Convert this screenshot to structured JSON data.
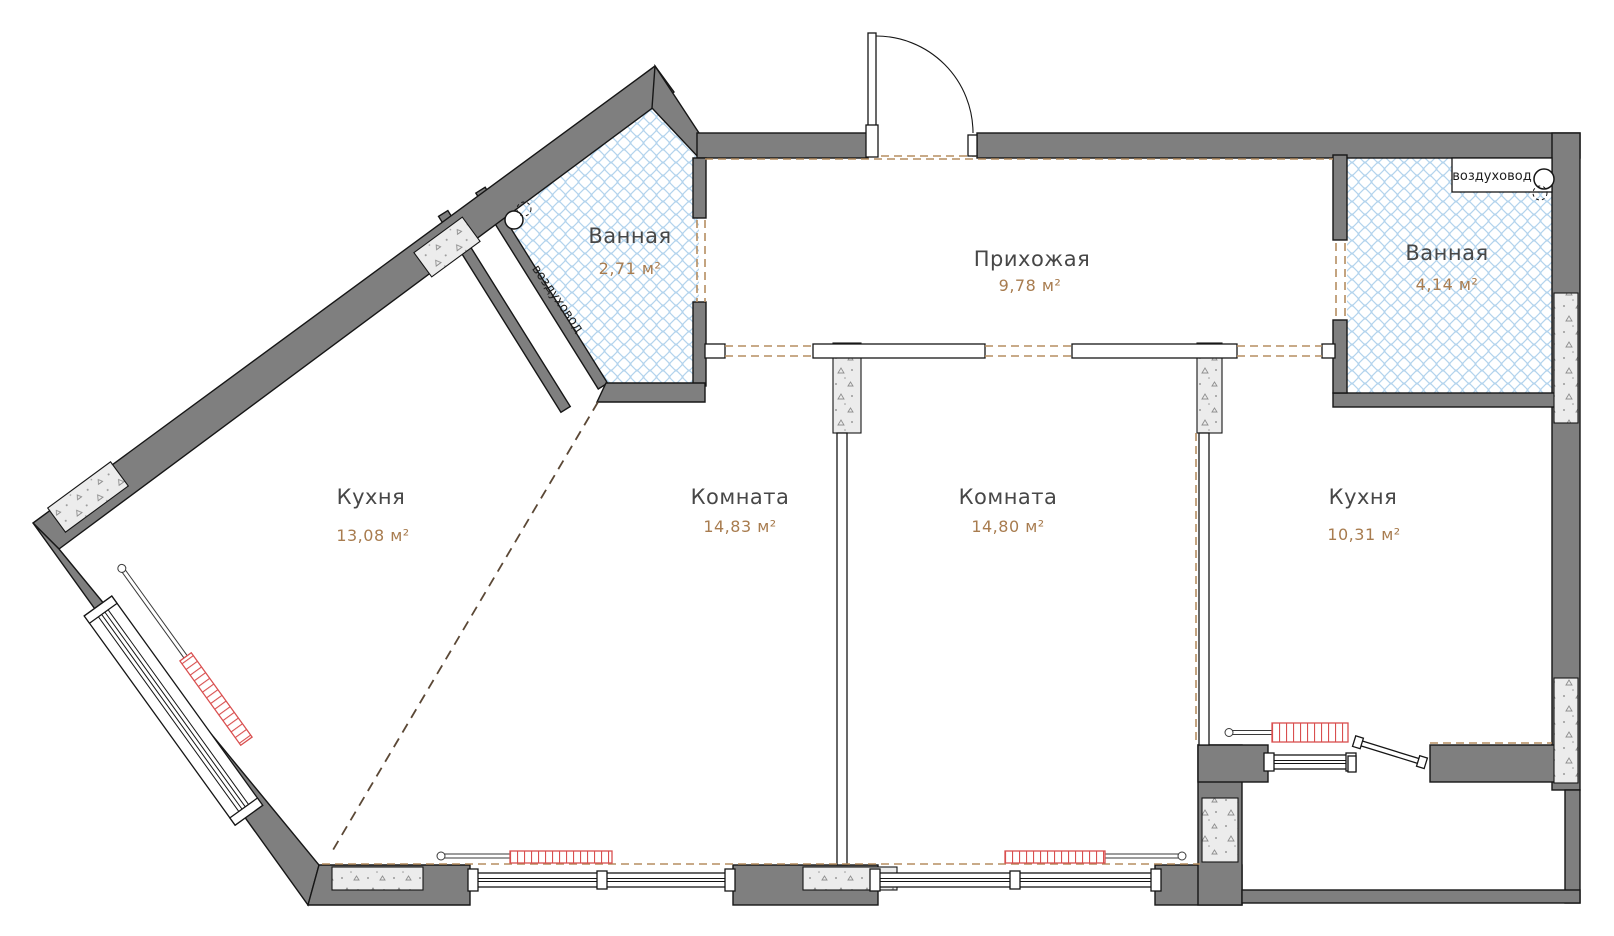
{
  "plan_type": "apartment-floor-plan",
  "rooms": [
    {
      "key": "bathroom_left",
      "name": "Ванная",
      "area": "2,71 м²"
    },
    {
      "key": "hallway",
      "name": "Прихожая",
      "area": "9,78 м²"
    },
    {
      "key": "bathroom_right",
      "name": "Ванная",
      "area": "4,14 м²"
    },
    {
      "key": "kitchen_left",
      "name": "Кухня",
      "area": "13,08 м²"
    },
    {
      "key": "room_left",
      "name": "Комната",
      "area": "14,83 м²"
    },
    {
      "key": "room_right",
      "name": "Комната",
      "area": "14,80 м²"
    },
    {
      "key": "kitchen_right",
      "name": "Кухня",
      "area": "10,31 м²"
    }
  ],
  "ducts": {
    "left": "воздуховод",
    "right": "воздуховод"
  },
  "colors": {
    "wall": "#7f7f7f",
    "tile_line": "#b3d4ed",
    "dash_brown": "#b68e60",
    "dash_dark": "#5b4836",
    "radiator": "#d94f4f",
    "room_name_text": "#474747",
    "area_text": "#a87c4f"
  }
}
